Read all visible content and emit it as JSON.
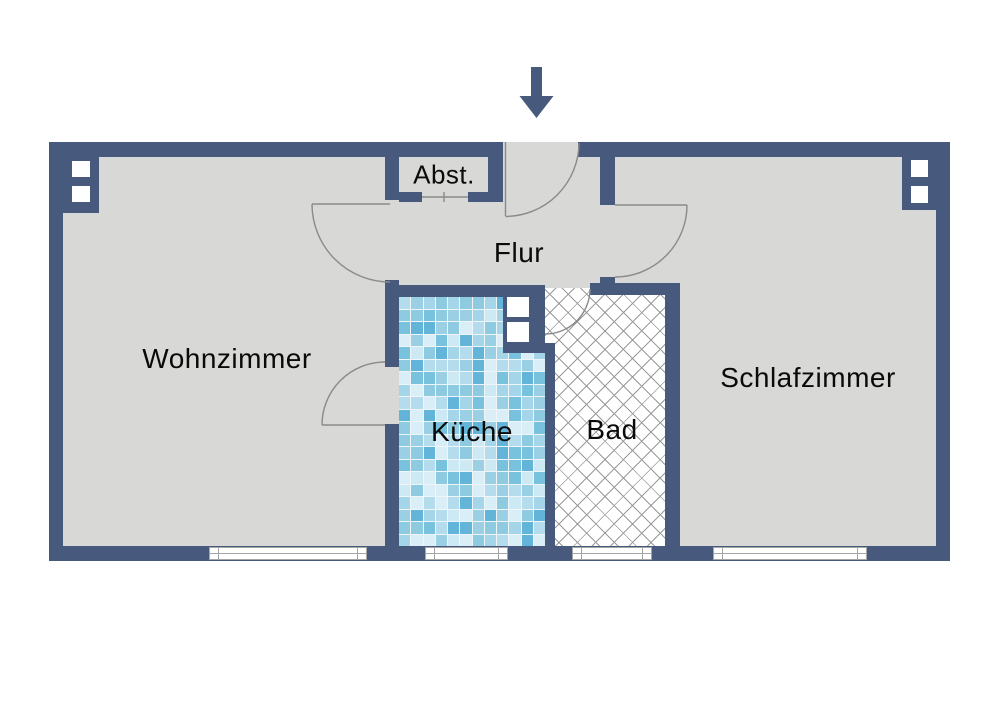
{
  "plan_title": "apartment-floor-plan",
  "colors": {
    "wall": "#475a7d",
    "floor": "#d8d8d6",
    "door_line": "#8a8a8a",
    "hatch_line": "#9a9a9a",
    "window_line": "#a5a5a5",
    "label": "#0a0a0a"
  },
  "rooms": [
    {
      "id": "wohnzimmer",
      "label": "Wohnzimmer"
    },
    {
      "id": "flur",
      "label": "Flur"
    },
    {
      "id": "abstellraum",
      "label": "Abst."
    },
    {
      "id": "kueche",
      "label": "Küche"
    },
    {
      "id": "bad",
      "label": "Bad"
    },
    {
      "id": "schlafzimmer",
      "label": "Schlafzimmer"
    }
  ],
  "entrance": {
    "icon": "down-arrow"
  },
  "kitchen_tiles": {
    "rows": 20,
    "cols": 12,
    "palette": [
      "#d9eef7",
      "#b5dcec",
      "#8ecbe1",
      "#62b5d8",
      "#a5d5e8",
      "#79c2dd",
      "#cde9f3",
      "#9bd0e4"
    ]
  }
}
